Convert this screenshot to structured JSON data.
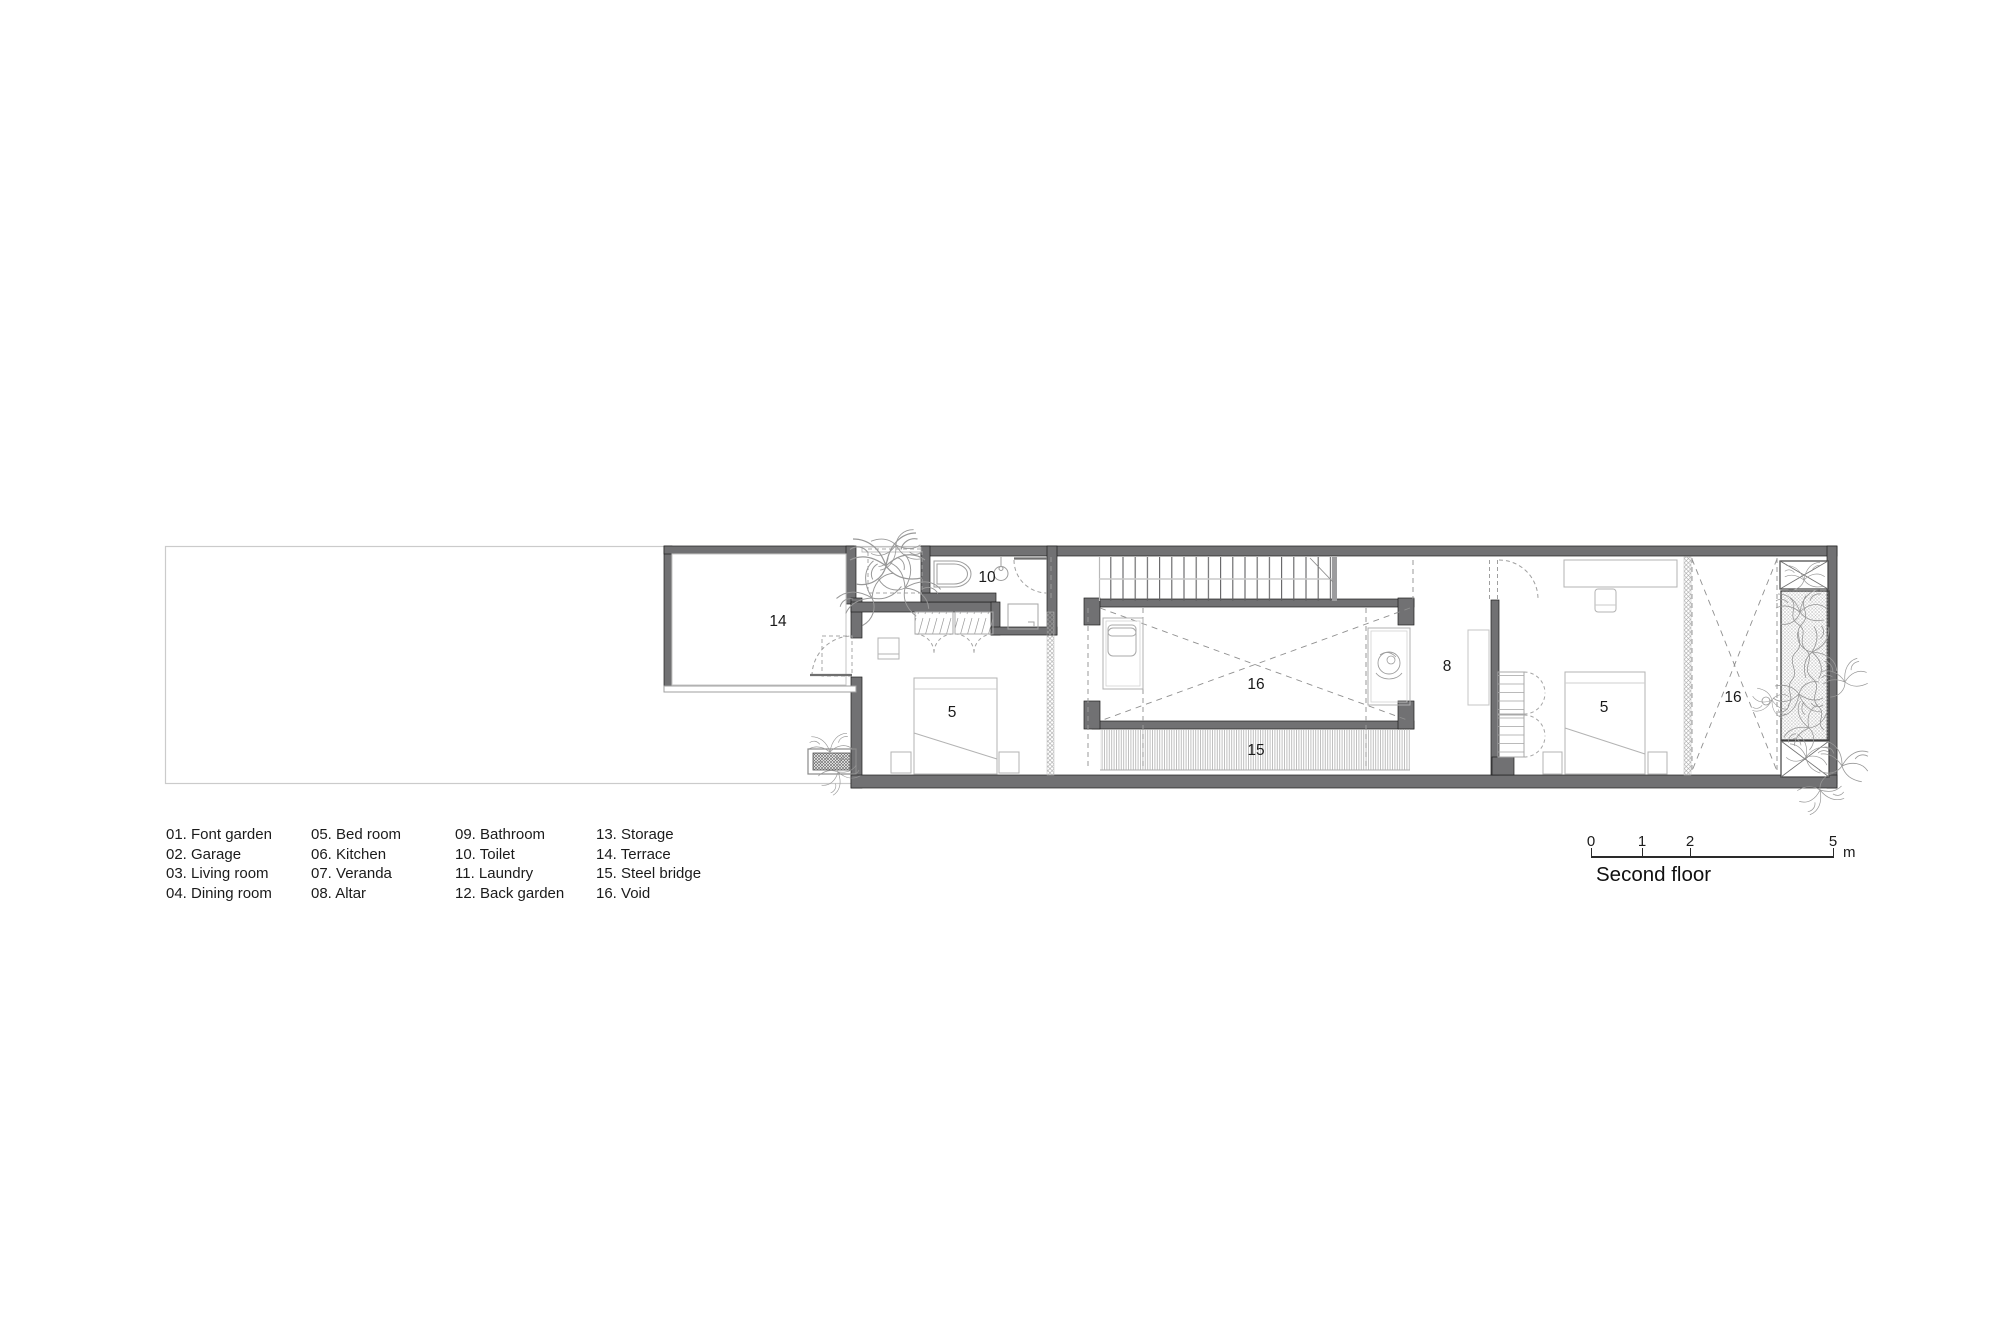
{
  "title": "Second floor",
  "plan": {
    "room_labels": {
      "terrace": "14",
      "toilet": "10",
      "bedroom_left": "5",
      "void_left": "16",
      "steel_bridge": "15",
      "altar": "8",
      "bedroom_right": "5",
      "void_right": "16"
    }
  },
  "legend": {
    "items": [
      "01. Font garden",
      "02. Garage",
      "03. Living room",
      "04. Dining room",
      "05. Bed room",
      "06. Kitchen",
      "07. Veranda",
      "08. Altar",
      "09. Bathroom",
      "10. Toilet",
      "11. Laundry",
      "12. Back garden",
      "13. Storage",
      "14. Terrace",
      "15. Steel bridge",
      "16. Void"
    ]
  },
  "scale_bar": {
    "ticks": [
      "0",
      "1",
      "2",
      "5"
    ],
    "unit": "m"
  },
  "colors": {
    "wall": "#717173",
    "light_line": "#b3b3b3",
    "dashed": "#999999",
    "lot": "#cbcbcb",
    "text": "#1b1b1b"
  }
}
